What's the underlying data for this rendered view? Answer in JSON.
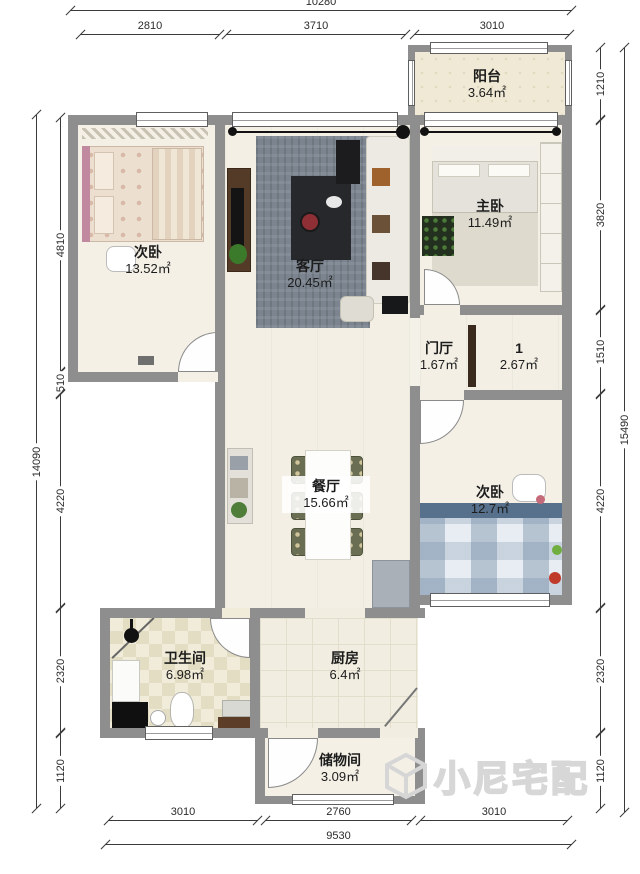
{
  "rooms": {
    "balcony": {
      "name": "阳台",
      "area": "3.64㎡"
    },
    "master_bedroom": {
      "name": "主卧",
      "area": "11.49㎡"
    },
    "bedroom_left": {
      "name": "次卧",
      "area": "13.52㎡"
    },
    "living": {
      "name": "客厅",
      "area": "20.45㎡"
    },
    "foyer": {
      "name": "门厅",
      "area": "1.67㎡"
    },
    "room1": {
      "name": "1",
      "area": "2.67㎡"
    },
    "dining": {
      "name": "餐厅",
      "area": "15.66㎡"
    },
    "bedroom_right": {
      "name": "次卧",
      "area": "12.7㎡"
    },
    "bathroom": {
      "name": "卫生间",
      "area": "6.98㎡"
    },
    "kitchen": {
      "name": "厨房",
      "area": "6.4㎡"
    },
    "storage": {
      "name": "储物间",
      "area": "3.09㎡"
    }
  },
  "dimensions": {
    "top": {
      "total": "10280",
      "segments": [
        "2810",
        "3710",
        "3010"
      ]
    },
    "bottom": {
      "total": "9530",
      "segments": [
        "3010",
        "2760",
        "3010"
      ]
    },
    "left": {
      "total": "14090",
      "segments": [
        "4810",
        "510",
        "4220",
        "2320",
        "1120"
      ]
    },
    "right": {
      "total": "15490",
      "segments": [
        "1210",
        "3820",
        "1510",
        "4220",
        "2320",
        "1120"
      ]
    }
  },
  "watermark": {
    "text": "小尼宅配"
  },
  "colors": {
    "wall": "#8e8e8e",
    "floor": "#f3efe5",
    "rug": "#7b848f",
    "bed_plaid": "#b3c6d9"
  }
}
